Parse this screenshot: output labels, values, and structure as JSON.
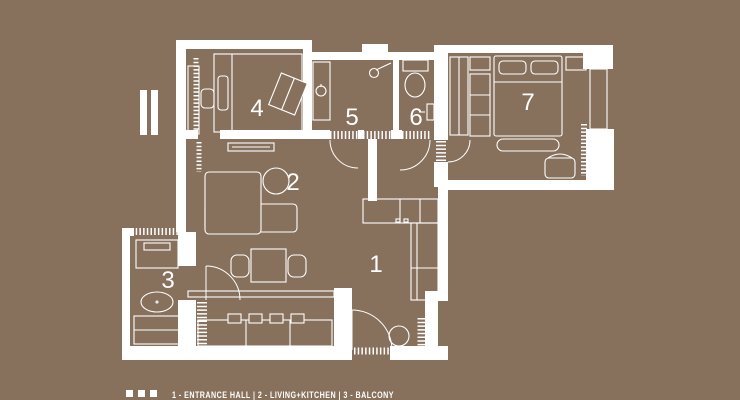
{
  "colors": {
    "background": "#87715C",
    "plan_line": "#FFFFFF"
  },
  "plan": {
    "room_numbers": [
      "1",
      "2",
      "3",
      "4",
      "5",
      "6",
      "7"
    ]
  },
  "legend": {
    "bullet_count": 3,
    "items": [
      {
        "number": "1",
        "label": "ENTRANCE HALL"
      },
      {
        "number": "2",
        "label": "LIVING+KITCHEN"
      },
      {
        "number": "3",
        "label": "BALCONY"
      }
    ],
    "text": "1 - ENTRANCE HALL | 2 - LIVING+KITCHEN | 3 - BALCONY"
  }
}
